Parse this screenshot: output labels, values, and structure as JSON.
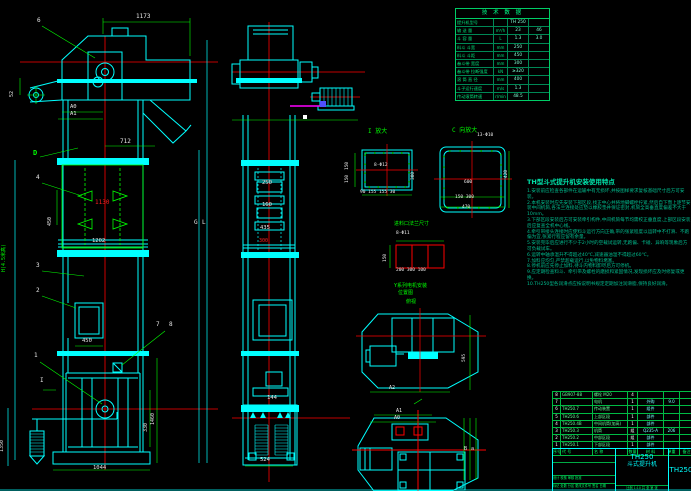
{
  "colors": {
    "background": "#000000",
    "line_cyan": "#00ffff",
    "line_green": "#00ff00",
    "centerline_red": "#ff0000",
    "bucket_yellow": "#ffff00",
    "highlight_magenta": "#ff00ff",
    "text_white": "#e8e8e8",
    "notes_teal": "#00bd8f"
  },
  "tech_table": {
    "title": "技 术 数 据",
    "rows": [
      {
        "label": "提升机型号",
        "unit": "",
        "v1": "TH 250",
        "v2": ""
      },
      {
        "label": "输 送 量",
        "unit": "m³/h",
        "v1": "23",
        "v2": "46"
      },
      {
        "label": "斗 容 量",
        "unit": "L",
        "v1": "1.3",
        "v2": "3.0"
      },
      {
        "label": "料斗 斗宽",
        "unit": "mm",
        "v1": "250",
        "v2": ""
      },
      {
        "label": "料斗 斗距",
        "unit": "mm",
        "v1": "450",
        "v2": ""
      },
      {
        "label": "畚斗带 宽度",
        "unit": "mm",
        "v1": "300",
        "v2": ""
      },
      {
        "label": "畚斗带 拉断强度",
        "unit": "kN",
        "v1": "≥320",
        "v2": ""
      },
      {
        "label": "滚 筒 直 径",
        "unit": "mm",
        "v1": "400",
        "v2": ""
      },
      {
        "label": "斗子运行速度",
        "unit": "m/s",
        "v1": "1.3",
        "v2": ""
      },
      {
        "label": "传动滚筒转速",
        "unit": "r/min",
        "v1": "48.5",
        "v2": ""
      }
    ]
  },
  "notes": {
    "title": "TH型斗式提升机安装使用特点",
    "lines": [
      "1.安装前应检查各部件在运输中有无损坏,并按图样要求复核基础尺寸后方可安装。",
      "2.本机安装时应先安装下部区段,找正中心并将地脚螺栓拧紧,然后自下而上逐节安装中间机筒,各法兰连接处应垫以橡胶垫并保证密封,机筒全高垂直度偏差不大于10mm。",
      "3.下部区段安装后方可安装牵引构件,中间机筒每节均需校正垂直度,上部区段安装后应复查全机中心线。",
      "4.牵引带接头连接时应使料斗运行方向正确,带的张紧程度以运转中不打滑、不跑偏为宜,张紧行程应留有余量。",
      "5.安装完毕后应进行不少于2小时的空载试运转,无跑偏、卡碰、异响等现象后方可负载试车。",
      "6.运转中轴承温升不得超过40℃,减速器油温不得超过60℃。",
      "7.加料应均匀,严禁超载运行,以免物料堵塞。",
      "8.停机前应先停止加料,待斗内物料卸尽后方可停机。",
      "9.应定期检查料斗、牵引带及螺栓的磨损和紧固情况,发现损坏应及时修复或更换。",
      "10.TH250型各润滑点应按说明书规定定期加注润滑脂,保持良好润滑。"
    ]
  },
  "bom": {
    "rows": [
      {
        "no": "8",
        "code": "GB907-88",
        "name": "螺栓 M20",
        "qty": "4",
        "mat": "",
        "wt": "",
        "note": ""
      },
      {
        "no": "7",
        "code": "",
        "name": "电机",
        "qty": "1",
        "mat": "外购",
        "wt": "9.0",
        "note": ""
      },
      {
        "no": "6",
        "code": "TH250.7",
        "name": "传动装置",
        "qty": "1",
        "mat": "组件",
        "wt": "",
        "note": ""
      },
      {
        "no": "5",
        "code": "TH250.6",
        "name": "上部区段",
        "qty": "1",
        "mat": "部件",
        "wt": "",
        "note": ""
      },
      {
        "no": "4",
        "code": "TH250.4B",
        "name": "中间机筒(加高)",
        "qty": "1",
        "mat": "部件",
        "wt": "",
        "note": ""
      },
      {
        "no": "3",
        "code": "TH250.3",
        "name": "机筒",
        "qty": "组",
        "mat": "Q235-A",
        "wt": "206",
        "note": ""
      },
      {
        "no": "2",
        "code": "TH250.2",
        "name": "中部区段",
        "qty": "组",
        "mat": "部件",
        "wt": "",
        "note": ""
      },
      {
        "no": "1",
        "code": "TH250.1",
        "name": "下部区段",
        "qty": "1",
        "mat": "部件",
        "wt": "",
        "note": ""
      }
    ],
    "header": {
      "no": "序号",
      "code": "代 号",
      "name": "名 称",
      "qty": "数量",
      "mat": "材 料",
      "wt": "单重",
      "note": "备注"
    }
  },
  "title_block": {
    "model": "TH250",
    "product": "斗式提升机",
    "model_right": "TH250",
    "sig_row": "标记 处数 分区 更改文件号 签名 日期",
    "roles": "设计  校核  审核  批准",
    "scale_row": "比例 1:10   共 张   第 张"
  },
  "labels": {
    "p1": "1",
    "p2": "2",
    "p3": "3",
    "p4": "4",
    "p6": "6",
    "p7": "7",
    "p8": "8",
    "D": "D",
    "I": "I",
    "L": "L",
    "G": "G",
    "A0": "A0",
    "A1": "A1",
    "H": "H(4.5米高)"
  },
  "dims": {
    "w1173": "1173",
    "w712": "712",
    "h52": "52",
    "p450": "450",
    "m1130": "1130",
    "m1202": "1202",
    "inlet450": "450",
    "v1460": "1460",
    "v330": "330",
    "v1350": "1350",
    "base1044": "1044",
    "s250": "250",
    "s160": "160",
    "s435": "435",
    "s300": "300",
    "s144": "144",
    "s524": "524",
    "det1_title": "I 放大",
    "det1_holes": "8-Φ12",
    "det1_l1": "150",
    "det1_l2": "150",
    "det1_r": "300",
    "det1_bot": "90 155 155 30",
    "detc_title": "C 向放大",
    "detc_holes": "13-Φ10",
    "detc_600": "600",
    "detc_bot1": "150 300",
    "detc_bot2": "470",
    "detc_420": "420",
    "inlet_title": "进料口法兰尺寸",
    "inlet_holes": "8-Φ11",
    "inlet_150": "150",
    "inlet_bot": "200 300 100",
    "motor_t1": "Y系列电机安装",
    "motor_t2": "位置图",
    "plan_t": "俯视",
    "plan1_595": "595",
    "plan1_a": "A2",
    "plan2_a1": "A1",
    "plan2_a0": "A0",
    "plan2_b": "B",
    "plan2_h": "a"
  }
}
